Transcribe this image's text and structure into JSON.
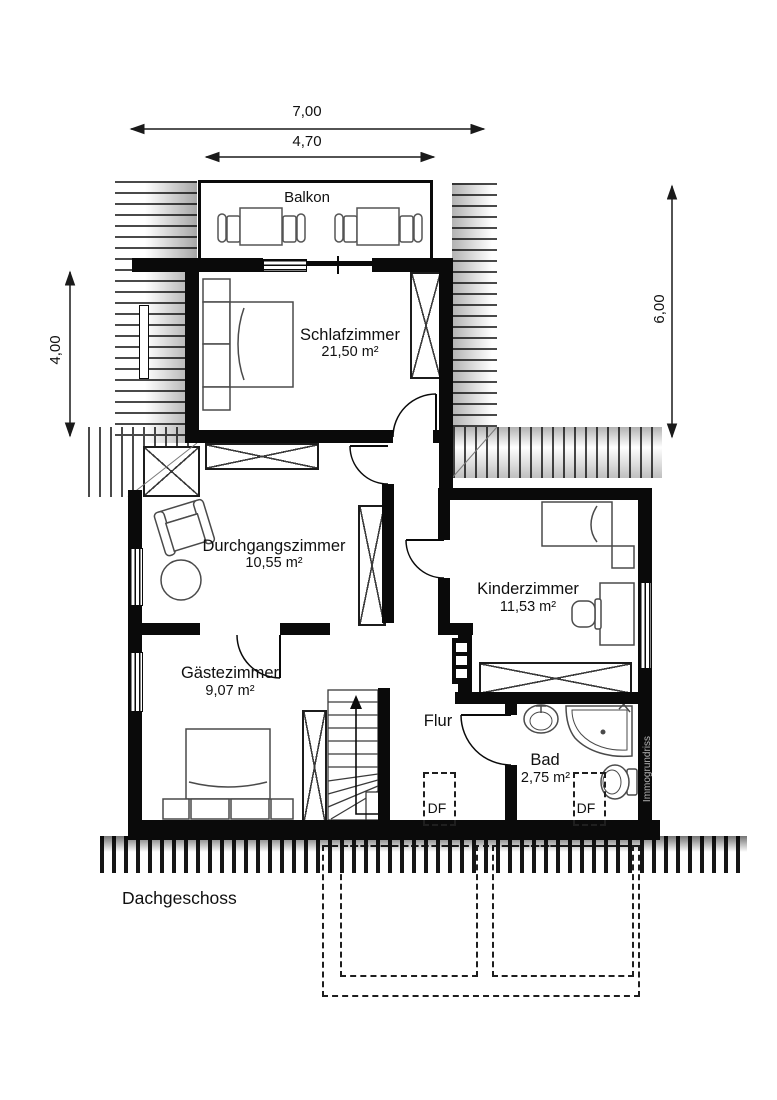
{
  "title": "Dachgeschoss",
  "watermark": "Immogrundriss",
  "dimensions": {
    "top_outer": "7,00",
    "top_inner": "4,70",
    "left": "4,00",
    "right": "6,00"
  },
  "labels": {
    "balcony": "Balkon",
    "hallway": "Flur",
    "roof_window": "DF"
  },
  "rooms": {
    "schlafzimmer": {
      "name": "Schlafzimmer",
      "area": "21,50 m²"
    },
    "durchgangszimmer": {
      "name": "Durchgangszimmer",
      "area": "10,55 m²"
    },
    "kinderzimmer": {
      "name": "Kinderzimmer",
      "area": "11,53 m²"
    },
    "gaestezimmer": {
      "name": "Gästezimmer",
      "area": "9,07 m²"
    },
    "bad": {
      "name": "Bad",
      "area": "2,75 m²"
    }
  },
  "colors": {
    "wall": "#0a0a0a",
    "line": "#2a2a2a",
    "hatch": "#4a4a4a",
    "watermark_text": "#b5b5b5"
  }
}
